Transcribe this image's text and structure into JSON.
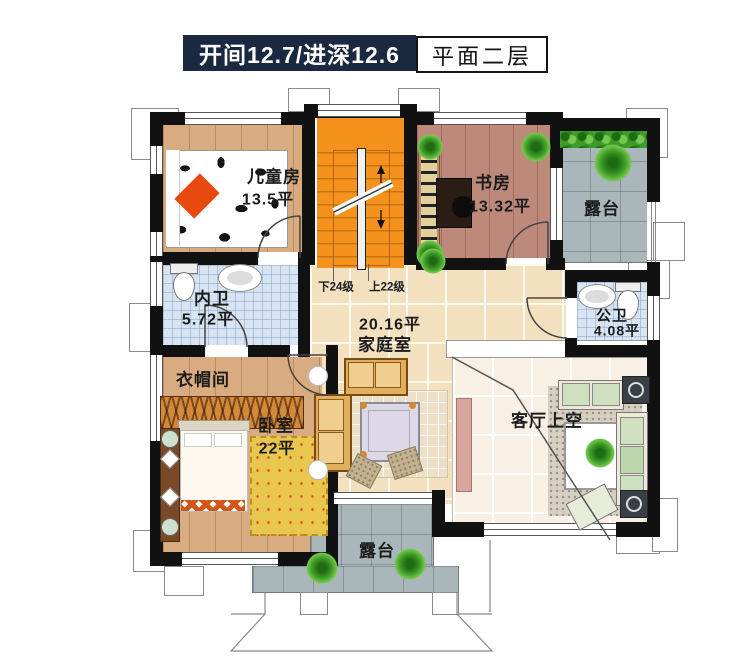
{
  "title": {
    "dimensions": "开间12.7/进深12.6",
    "floor": "平面二层"
  },
  "rooms": {
    "children": {
      "name": "儿童房",
      "area": "13.5平"
    },
    "study": {
      "name": "书房",
      "area": "13.32平"
    },
    "terrace_right": {
      "name": "露台"
    },
    "inner_bath": {
      "name": "内卫",
      "area": "5.72平"
    },
    "family": {
      "area": "20.16平",
      "name": "家庭室"
    },
    "public_bath": {
      "name": "公卫",
      "area": "4.08平"
    },
    "cloak": {
      "name": "衣帽间"
    },
    "bedroom": {
      "name": "卧室",
      "area": "22平"
    },
    "living_void": {
      "name": "客厅上空"
    },
    "terrace_bottom": {
      "name": "露台"
    }
  },
  "stairs": {
    "down": "下24级",
    "up": "上22级"
  },
  "colors": {
    "navy": "#1a2840",
    "stairs_orange": "#f5921e",
    "wall": "#111111",
    "wood_light": "#d8ab80",
    "wood_dark": "#bd897b",
    "tile_beige": "#f2e0bf",
    "tile_gray": "#a9b6ba",
    "tile_blue": "#d8e4f2"
  }
}
